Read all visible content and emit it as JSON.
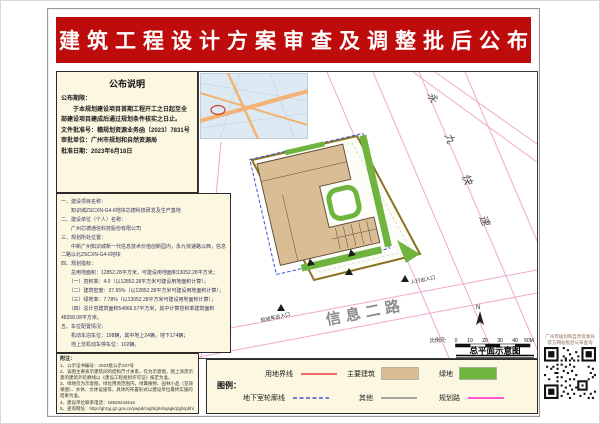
{
  "banner": {
    "title": "建筑工程设计方案审查及调整批后公布"
  },
  "notice": {
    "title": "公布说明",
    "lines": [
      "公布期限：",
      "　　于本规划建设项目首期工程开工之日起至全",
      "部建设项目建成后通过规划条件核实之日止。",
      "文件批准号：穗规划资源业务函〔2023〕7831号",
      "审批单位：广州市规划和自然资源局",
      "批准日期：2023年6月18日"
    ]
  },
  "details": {
    "lines": [
      "一、建设项目名称：",
      "　　知识城ZSCXN-G4-6地块芯德科技研发及生产基地",
      "二、建设单位（个人）名称：",
      "　　广州芯德通信科技股份有限公司",
      "三、规划所处位置：",
      "　　中新广州知识城新一代信息技术价值创新园内，永九快速路以西，信息",
      "二路以北ZSCXN-G4-6地块",
      "四、规划指标：",
      "　　总用地面积：12852.28平方米，可建设用地面积13052.28平方米；",
      "　　（一）容积率：4.0（以12852.28平方米可建设用地面积计算）；",
      "　　（二）建筑密度：37.65%（以12852.28平方米可建设用地面积计算）；",
      "　　（三）绿地率：7.78%（以13052.28平方米可建设用地面积计算）；",
      "　　（四）总计容建筑面积54866.57平方米，其中计算容积率建筑面积",
      "48358.08平方米。",
      "五、车位配置情况：",
      "　　机动车泊车位：198辆，其中地上24辆，地下174辆；",
      "　　地上非机动车停车位：102辆。"
    ]
  },
  "footnotes": {
    "title": "附注：",
    "lines": [
      "1、公示证书编号：2023批公示337号",
      "2、该图主要表示建筑间的结构尺寸关系，仅为示意图，图上涂黑示意的建筑外轮廓线以《建设工程规划许可证》核定为准。",
      "3、绿地仅为示意图，绿化用地范围内，绿篱植物、园林小品（见效果图）、水体、文体设施等，具体的布置形式以建设单位最终实施的结果为准。",
      "4、建设单位联系电话：18928244616",
      "5、查询网址：http://ghzyj.gz.gov.cn/ywpd/csgh/ghshqsgk/jzgh/pbh/"
    ]
  },
  "map": {
    "roads": {
      "expressway": "永九快速",
      "secondary": "信息二路"
    },
    "entrances": {
      "vehicle": "机动车出入口",
      "pedestrian": "人行出入口"
    },
    "north_label": "N",
    "scale": {
      "label": "比例尺:",
      "ticks": [
        "0",
        "10",
        "20",
        "30",
        "40",
        "50M"
      ]
    },
    "caption": "总平面示意图"
  },
  "legend": {
    "title": "图例：",
    "items": [
      {
        "label": "用地界线",
        "symbol": "line-solid-red"
      },
      {
        "label": "主要建筑",
        "symbol": "swatch-tan"
      },
      {
        "label": "绿地",
        "symbol": "swatch-green"
      },
      {
        "label": "地下室轮廓线",
        "symbol": "line-dashed-blue"
      },
      {
        "label": "其他",
        "symbol": "line-solid-gray"
      },
      {
        "label": "规划路",
        "symbol": "line-solid-magenta"
      }
    ]
  },
  "qr": {
    "caption_line1": "广州市规划和自然资源局",
    "caption_line2": "官方网站批后公布查询"
  },
  "colors": {
    "banner_red": "#BE0B0B",
    "panel_cream": "#FBF7E1",
    "boundary_red": "#E8403A",
    "building_tan": "#D8BD95",
    "green": "#6EB43E",
    "underground_blue": "#4156D8",
    "other_gray": "#8C8C8C",
    "planning_magenta": "#FF3FD1",
    "road_pink": "#F0A8CF",
    "site_boundary_olive": "#8A7320",
    "inset_bg": "#DDE9F3",
    "inset_road": "#F2B375"
  }
}
